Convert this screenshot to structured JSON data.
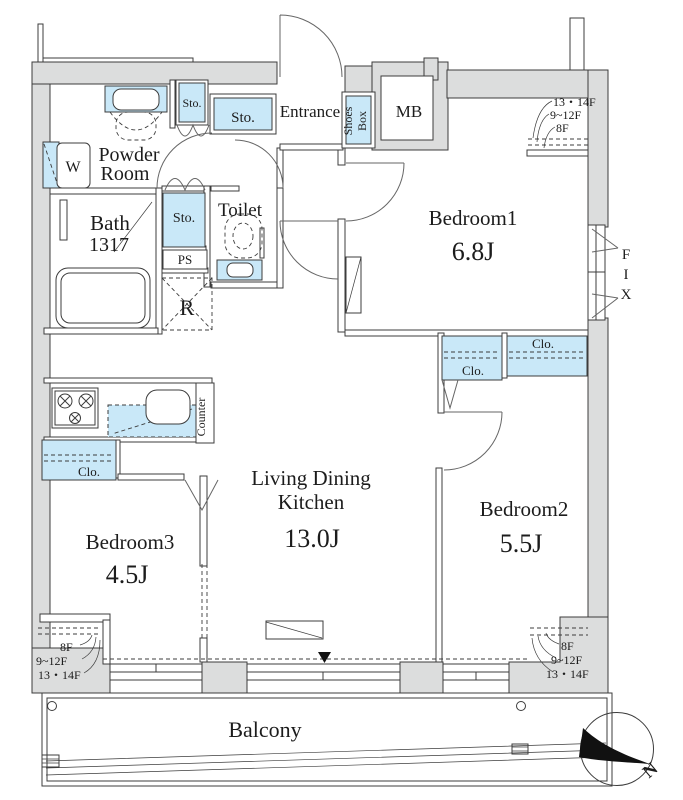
{
  "rooms": {
    "bedroom1": {
      "name": "Bedroom1",
      "size": "6.8J"
    },
    "bedroom2": {
      "name": "Bedroom2",
      "size": "5.5J"
    },
    "bedroom3": {
      "name": "Bedroom3",
      "size": "4.5J"
    },
    "ldk": {
      "line1": "Living Dining",
      "line2": "Kitchen",
      "size": "13.0J"
    },
    "bath": {
      "name": "Bath",
      "size": "1317"
    },
    "powder": {
      "line1": "Powder",
      "line2": "Room"
    },
    "toilet": "Toilet",
    "entrance": "Entrance",
    "balcony": "Balcony"
  },
  "fixtures": {
    "storage": "Sto.",
    "closet": "Clo.",
    "shoes_line1": "Shoes",
    "shoes_line2": "Box",
    "meter_box": "MB",
    "pipe_space": "PS",
    "refrigerator": "R",
    "washer": "W",
    "counter": "Counter",
    "fix_f": "F",
    "fix_i": "I",
    "fix_x": "X"
  },
  "floor_notes": {
    "f13_14": "13・14F",
    "f9_12": "9~12F",
    "f8": "8F"
  },
  "compass": {
    "north": "N"
  },
  "colors": {
    "fixture": "#c9e8f8",
    "wall": "#dcdddd",
    "line": "#3c3c3c",
    "text": "#1c1c1c",
    "door": "#666666",
    "north_black": "#111111"
  }
}
